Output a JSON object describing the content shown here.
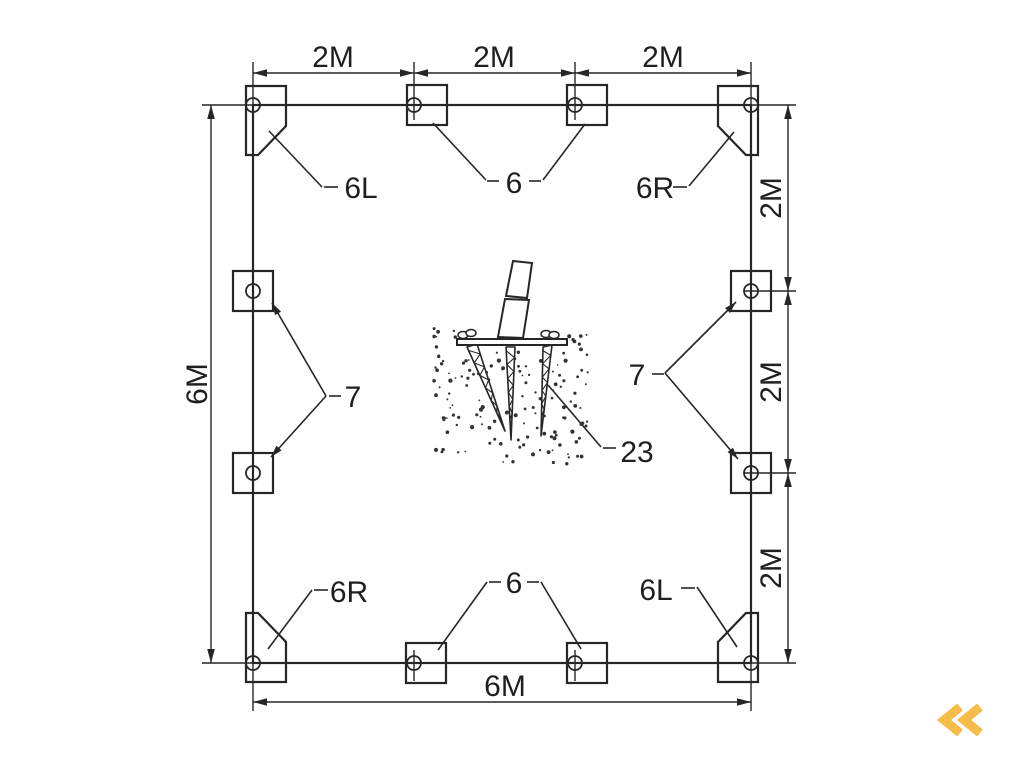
{
  "colors": {
    "line": "#262626",
    "text": "#1f1f1f",
    "background": "#ffffff",
    "logo_accent": "#f6bc49"
  },
  "dimensions": {
    "top": [
      "2M",
      "2M",
      "2M"
    ],
    "right": [
      "2M",
      "2M",
      "2M"
    ],
    "left": "6M",
    "bottom": "6M"
  },
  "part_labels": {
    "top_left": "6L",
    "top_center": "6",
    "top_right": "6R",
    "left": "7",
    "right": "7",
    "bottom_left": "6R",
    "bottom_center": "6",
    "bottom_right": "6L",
    "ground_anchor": "23"
  },
  "logo": {
    "icon": "double-chevron-left"
  }
}
